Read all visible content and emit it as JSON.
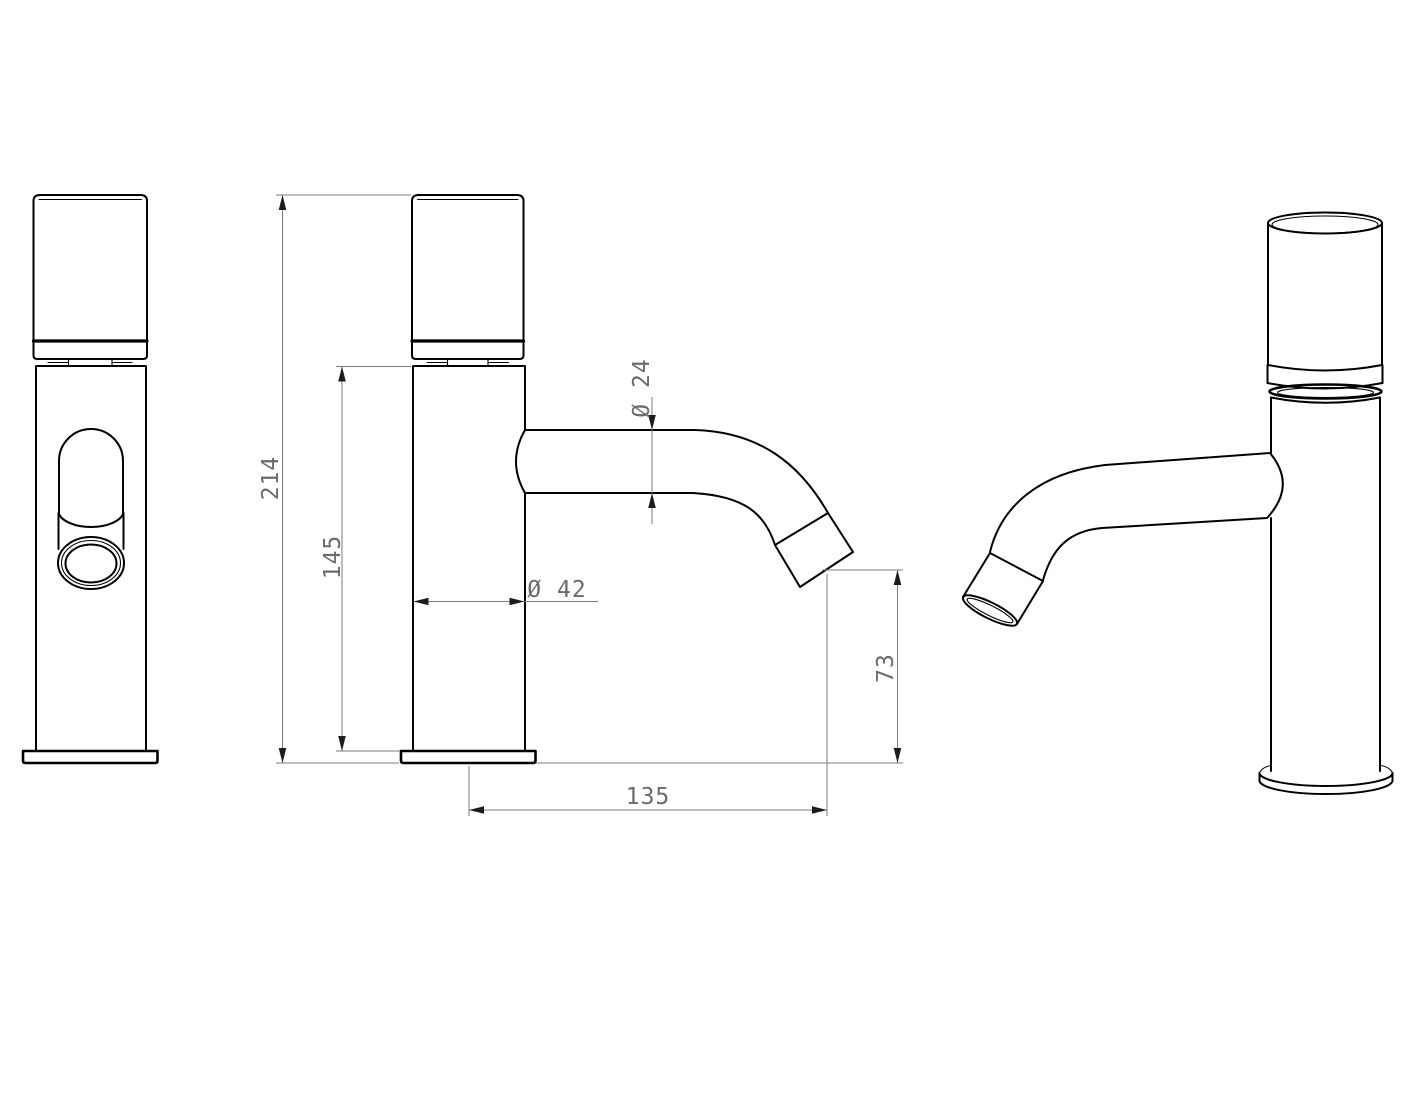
{
  "drawing": {
    "type": "faucet-technical-drawing",
    "colors": {
      "background": "#ffffff",
      "object_line": "#000000",
      "dimension_line": "#7b7b7b",
      "arrow": "#1c1c1c",
      "label": "#6b6b6b"
    },
    "dims": {
      "total_height": {
        "label": "214"
      },
      "body_height": {
        "label": "145"
      },
      "spout_diameter": {
        "label": "Ø 24"
      },
      "body_diameter": {
        "label": "Ø 42"
      },
      "outlet_height": {
        "label": "73"
      },
      "reach": {
        "label": "135"
      }
    }
  }
}
